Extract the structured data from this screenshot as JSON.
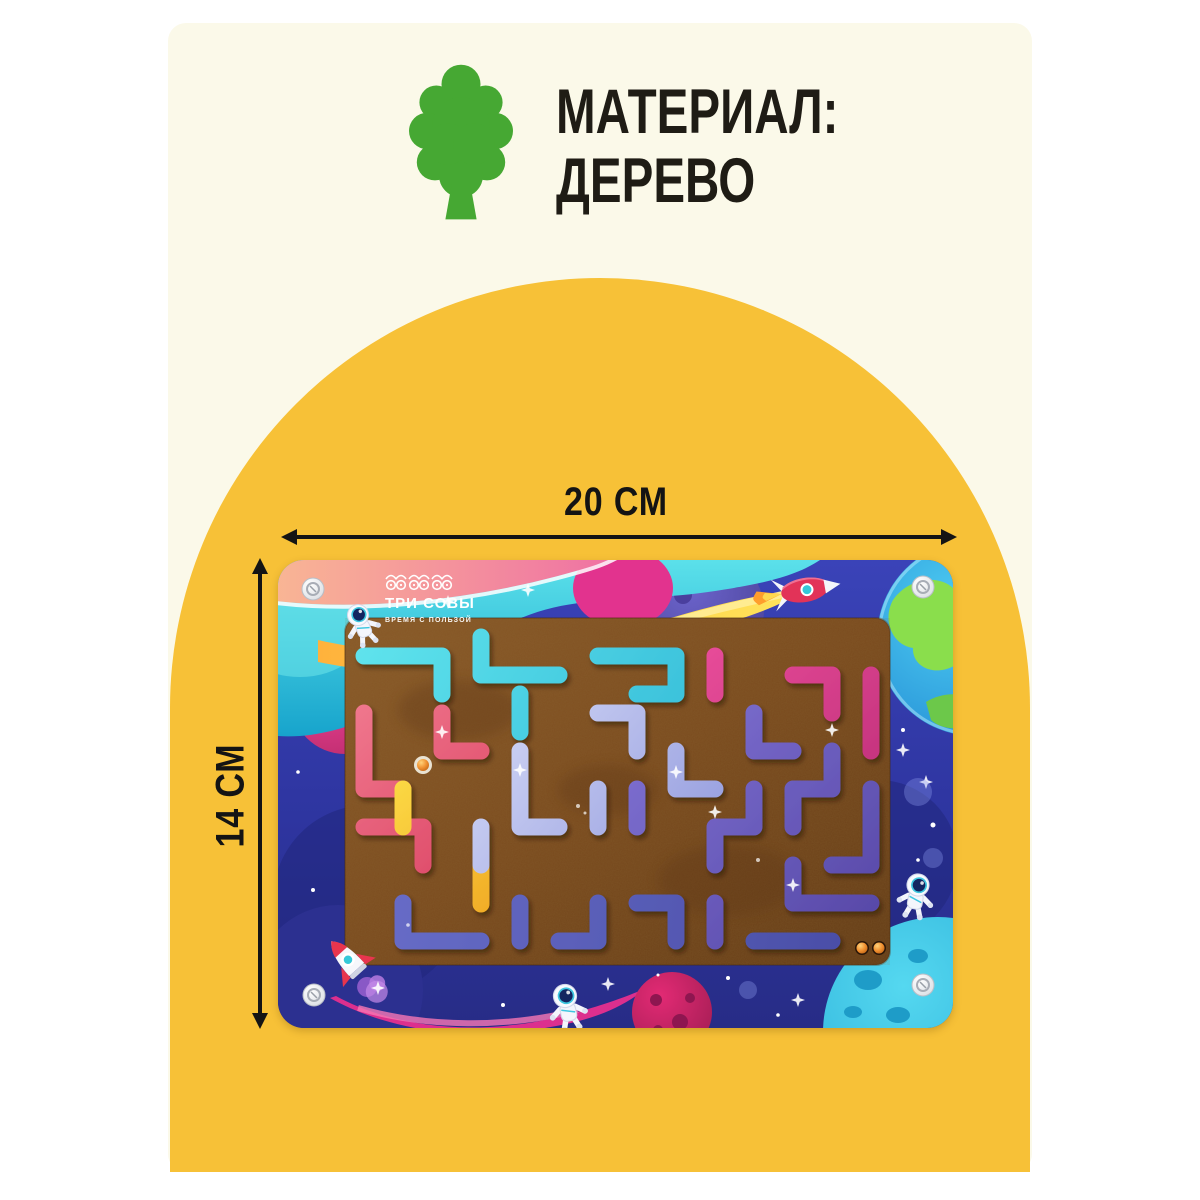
{
  "colors": {
    "page_background": "#ffffff",
    "panel_cream": "#fbf9e9",
    "arch_yellow": "#f7c137",
    "tree_green": "#46a833",
    "text_dark": "#1f1c15",
    "annotation_black": "#141414",
    "space_blue": "#2f36a0",
    "maze_wood_brown": "#7b4b1e"
  },
  "material": {
    "icon": "tree-icon",
    "line1": "МАТЕРИАЛ:",
    "line2": "ДЕРЕВО"
  },
  "dimensions": {
    "width": "20 СМ",
    "height": "14 СМ"
  },
  "board": {
    "brand": "ТРИ СОВЫ",
    "tagline": "ВРЕМЯ С ПОЛЬЗОЙ",
    "corner_screws": 4,
    "visible_balls": 3
  }
}
